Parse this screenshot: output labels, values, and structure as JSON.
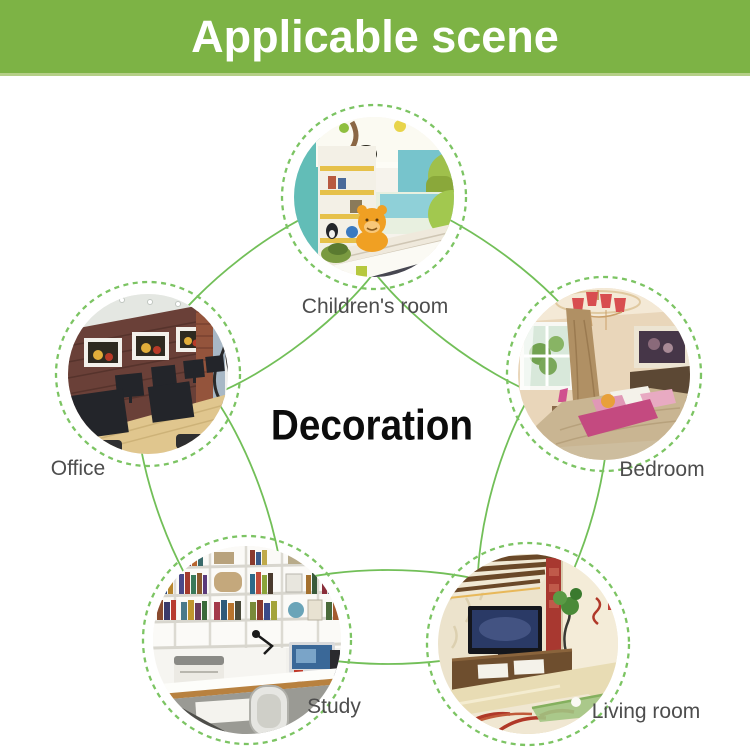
{
  "header": {
    "title": "Applicable scene"
  },
  "center": {
    "title": "Decoration"
  },
  "scenes": [
    {
      "label": "Children's room",
      "image_alt": "childrens-room-photo"
    },
    {
      "label": "Office",
      "image_alt": "office-photo"
    },
    {
      "label": "Bedroom",
      "image_alt": "bedroom-photo"
    },
    {
      "label": "Study",
      "image_alt": "study-photo"
    },
    {
      "label": "Living room",
      "image_alt": "living-room-photo"
    }
  ],
  "colors": {
    "header_bg": "#7db345",
    "header_border": "#b5cf87",
    "header_text": "#ffffff",
    "ring_green": "#7cc463",
    "oval_green": "#72bf58",
    "label_text": "#4d4d4d",
    "center_text": "#0c0c0c"
  }
}
